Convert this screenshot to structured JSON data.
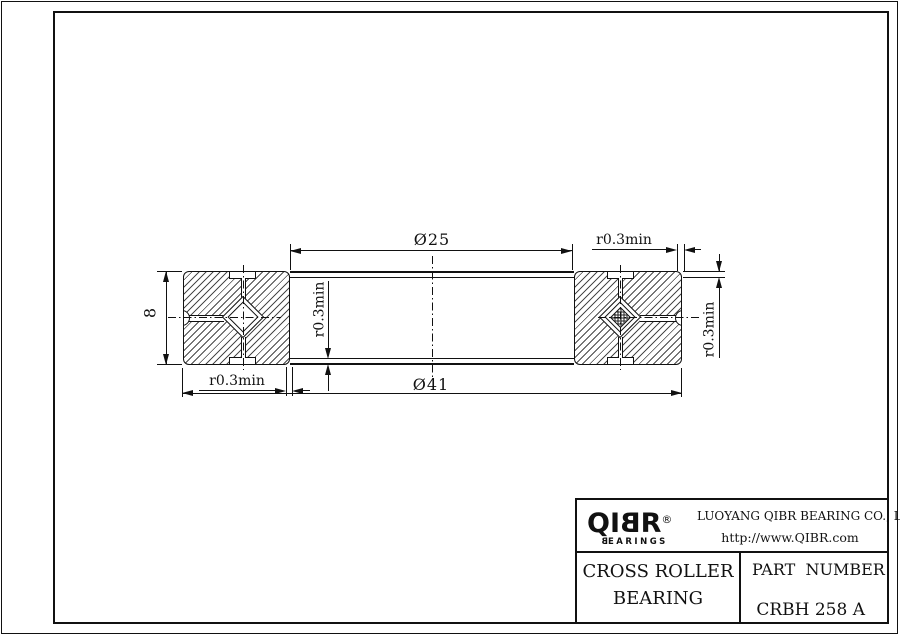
{
  "drawing": {
    "bore_diameter": "Ø25",
    "outer_diameter": "Ø41",
    "section_width": "8",
    "fillet_min": "r0.3min"
  },
  "title_block": {
    "brand": {
      "prefix": "QI",
      "mirrored_letter": "B",
      "suffix": "R",
      "registered": "®",
      "tagline_first": "B",
      "tagline_rest": "EARINGS"
    },
    "company_name": "LUOYANG QIBR BEARING CO., LTD",
    "website": "http://www.QIBR.com",
    "product_name_line1": "CROSS ROLLER",
    "product_name_line2": "BEARING",
    "part_number_label": "PART  NUMBER",
    "part_number_value": "CRBH 258 A"
  }
}
